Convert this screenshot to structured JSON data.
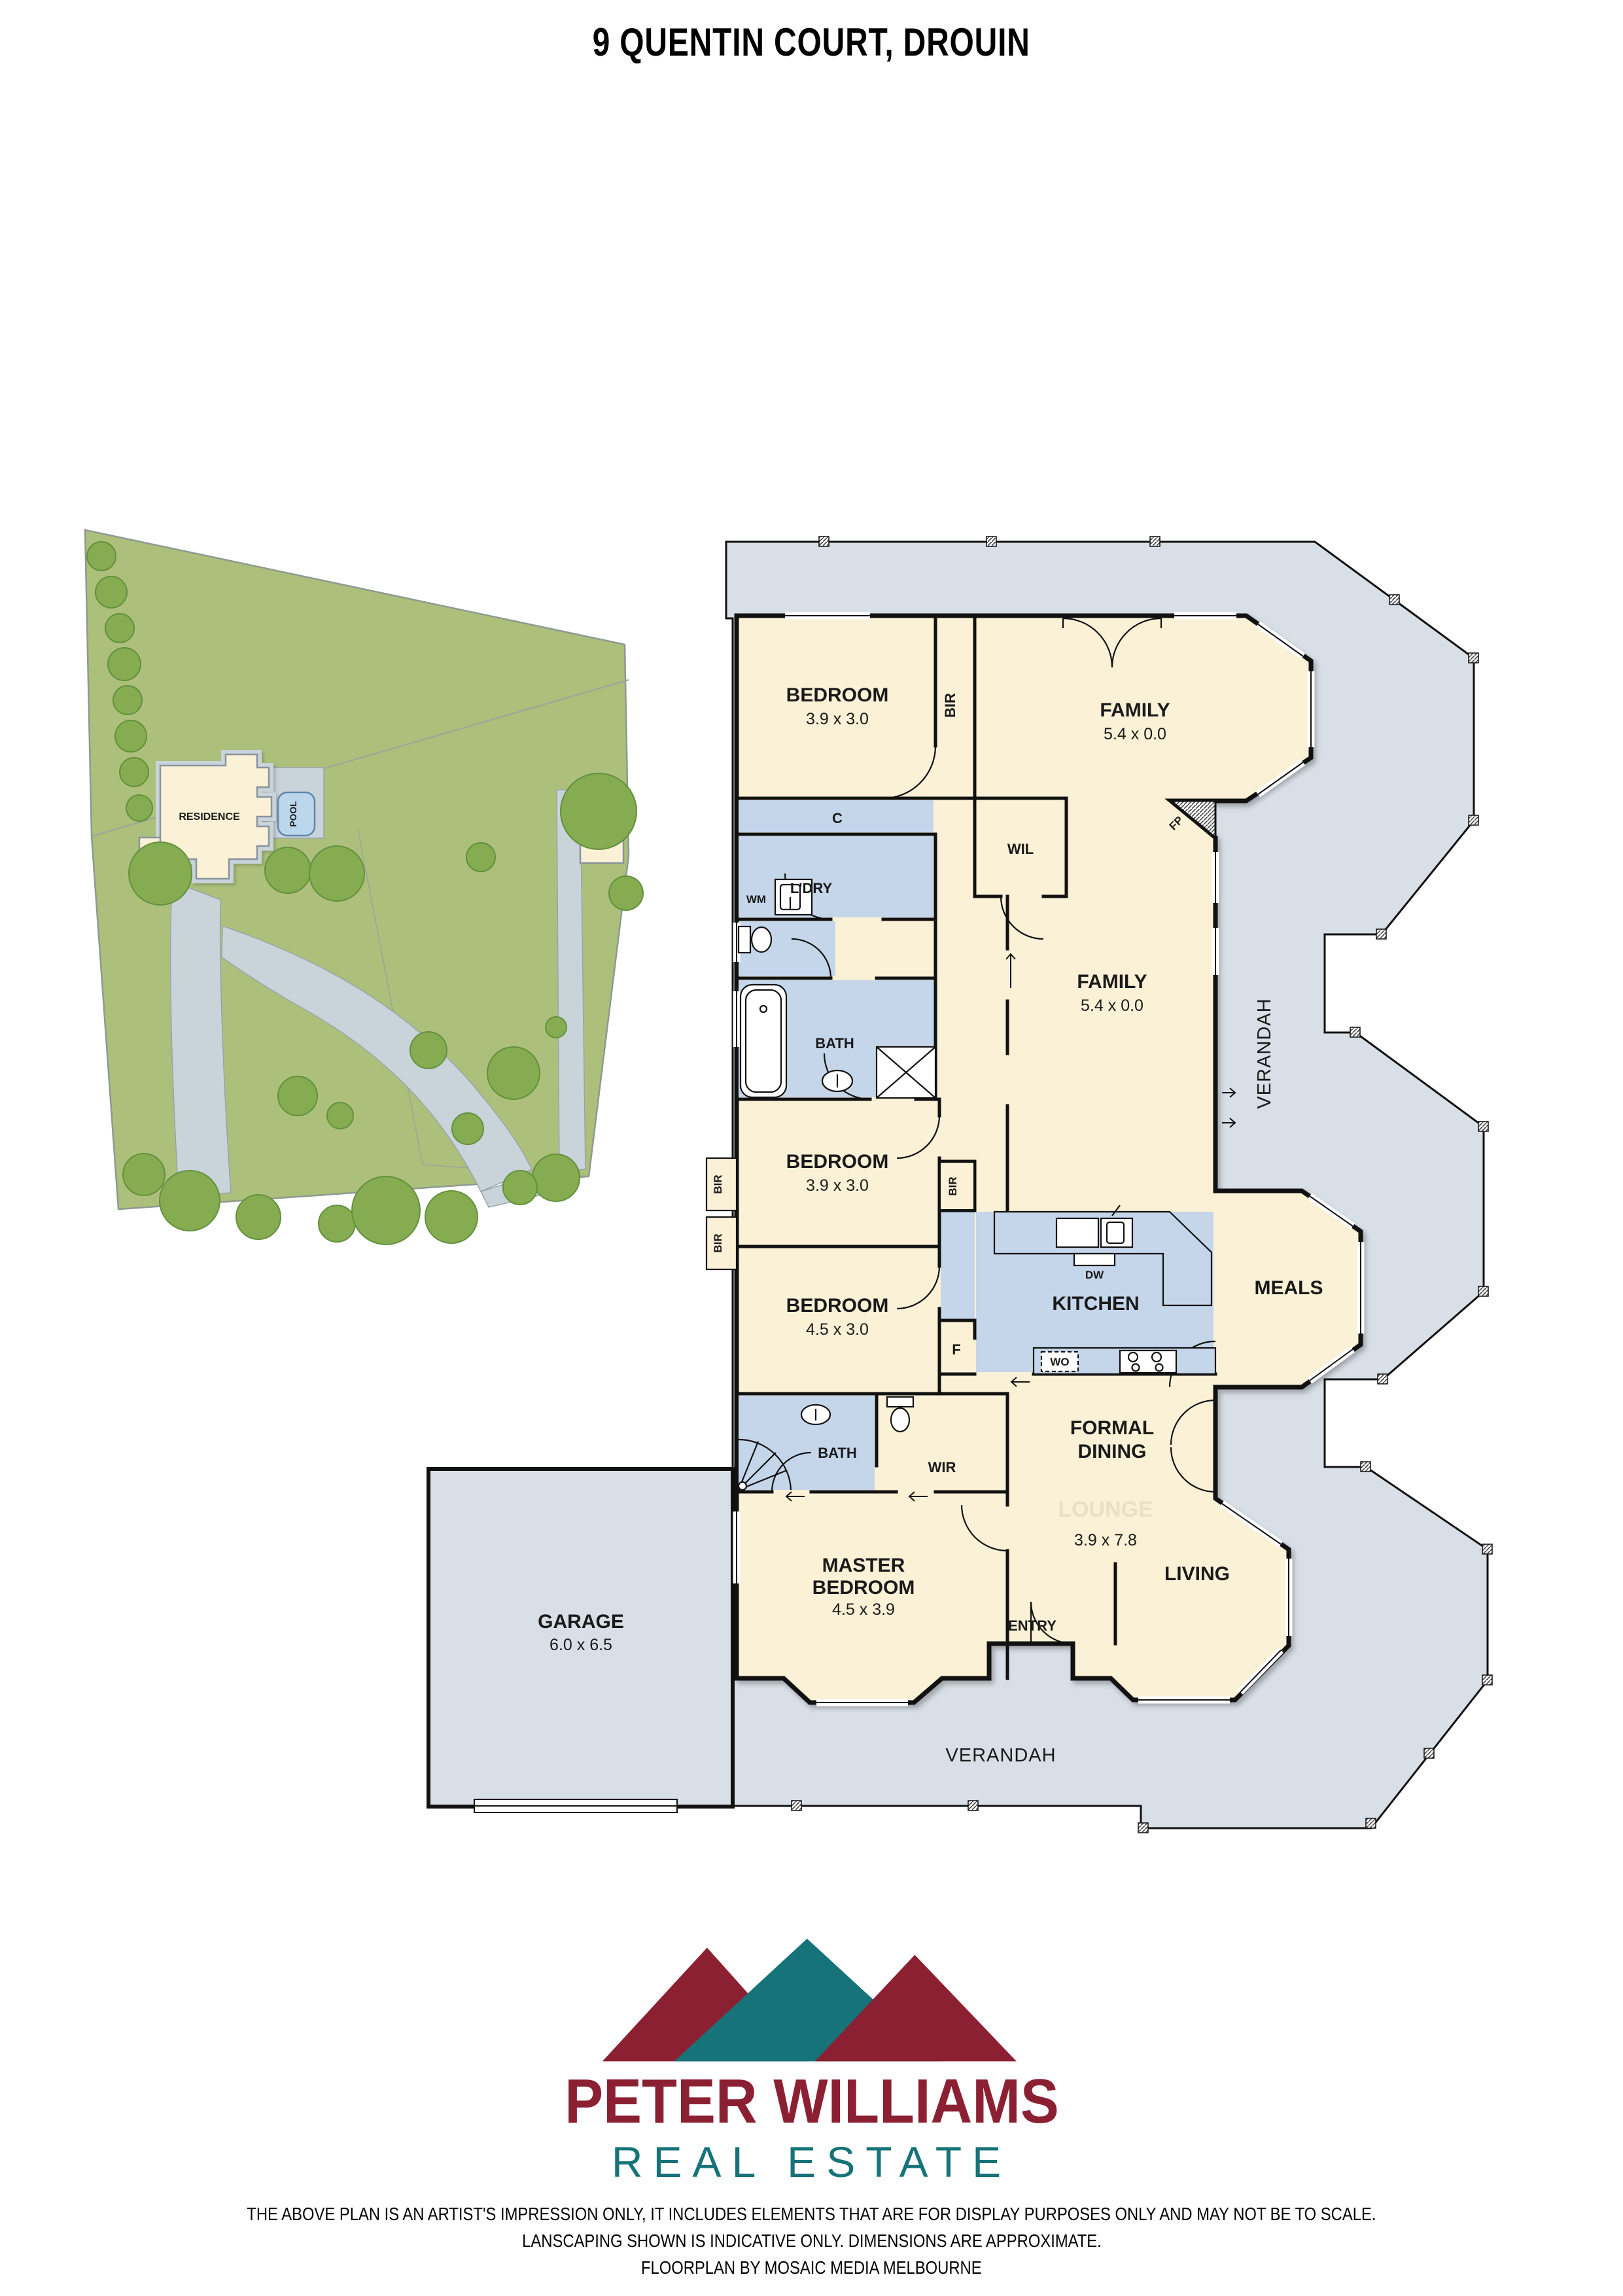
{
  "title": "9 QUENTIN COURT, DROUIN",
  "site_plan": {
    "residence": "RESIDENCE",
    "pool": "POOL",
    "shed": "SHED"
  },
  "floorplan": {
    "bedroom2": {
      "name": "BEDROOM",
      "dims": "3.9 x 3.0"
    },
    "bedroom3": {
      "name": "BEDROOM",
      "dims": "3.9 x 3.0"
    },
    "bedroom4": {
      "name": "BEDROOM",
      "dims": "4.5 x 3.0"
    },
    "master": {
      "line1": "MASTER",
      "line2": "BEDROOM",
      "dims": "4.5 x 3.9"
    },
    "family_upper": {
      "name": "FAMILY",
      "dims": "5.4 x 0.0"
    },
    "family_lower": {
      "name": "FAMILY",
      "dims": "5.4 x 0.0"
    },
    "kitchen": {
      "name": "KITCHEN"
    },
    "meals": {
      "name": "MEALS"
    },
    "formal_dining": {
      "line1": "FORMAL",
      "line2": "DINING",
      "dims": "3.9 x 7.8"
    },
    "living": {
      "name": "LIVING"
    },
    "entry": {
      "name": "ENTRY"
    },
    "garage": {
      "name": "GARAGE",
      "dims": "6.0 x 6.5"
    },
    "bath": "BATH",
    "ensuite_bath": "BATH",
    "laundry": "L'DRY",
    "wil": "WIL",
    "wir": "WIR",
    "cupboard": "C",
    "wm": "WM",
    "fridge": "F",
    "dw": "DW",
    "wo": "WO",
    "fp": "FP",
    "bir": "BIR",
    "verandah": "VERANDAH",
    "watermark_lounge": "LOUNGE"
  },
  "logo": {
    "brand_line1": "PETER WILLIAMS",
    "brand_line2": "REAL ESTATE",
    "maroon": "#8C2033",
    "teal": "#167379"
  },
  "disclaimer": {
    "line1": "THE ABOVE PLAN IS AN ARTIST'S IMPRESSION ONLY, IT INCLUDES ELEMENTS THAT ARE FOR DISPLAY PURPOSES ONLY AND MAY NOT BE TO SCALE.",
    "line2": "LANSCAPING SHOWN IS INDICATIVE ONLY. DIMENSIONS ARE APPROXIMATE.",
    "line3": "FLOORPLAN BY MOSAIC MEDIA MELBOURNE"
  }
}
